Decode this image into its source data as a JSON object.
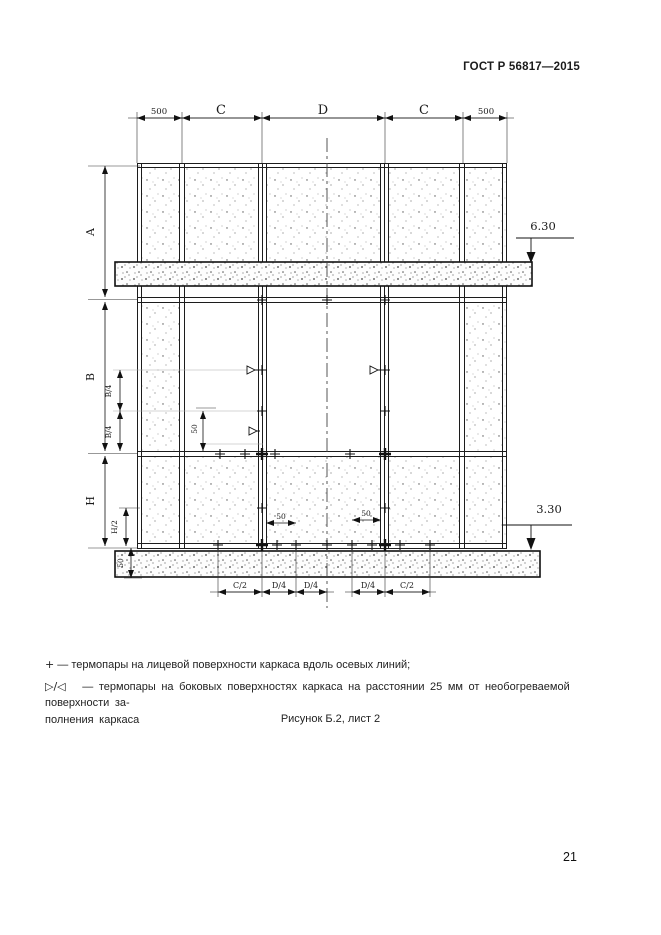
{
  "doc": {
    "header": "ГОСТ Р 56817—2015",
    "caption": "Рисунок Б.2, лист 2",
    "page_number": "21"
  },
  "legend": {
    "item1": {
      "symbol": "+",
      "text": "— термопары на лицевой поверхности каркаса вдоль осевых линий;"
    },
    "item2": {
      "symbol": "▷/◁",
      "text_line1": "— термопары на боковых поверхностях каркаса на расстоянии 25 мм от необогреваемой поверхности за-",
      "text_line2": "полнения каркаса"
    }
  },
  "drawing": {
    "top_dims": [
      "500",
      "C",
      "D",
      "C",
      "500"
    ],
    "left_dims": [
      "A",
      "B",
      "H"
    ],
    "sub_dims": {
      "b4a": "B/4",
      "b4b": "B/4",
      "h2": "H/2",
      "t50": "50"
    },
    "inner_dims": {
      "v50": "50",
      "h50l": "50",
      "h50r": "50"
    },
    "bottom_dims": [
      "C/2",
      "D/4",
      "D/4",
      "D/4",
      "C/2"
    ],
    "levels": {
      "top": "6.30",
      "bottom": "3.30"
    }
  }
}
